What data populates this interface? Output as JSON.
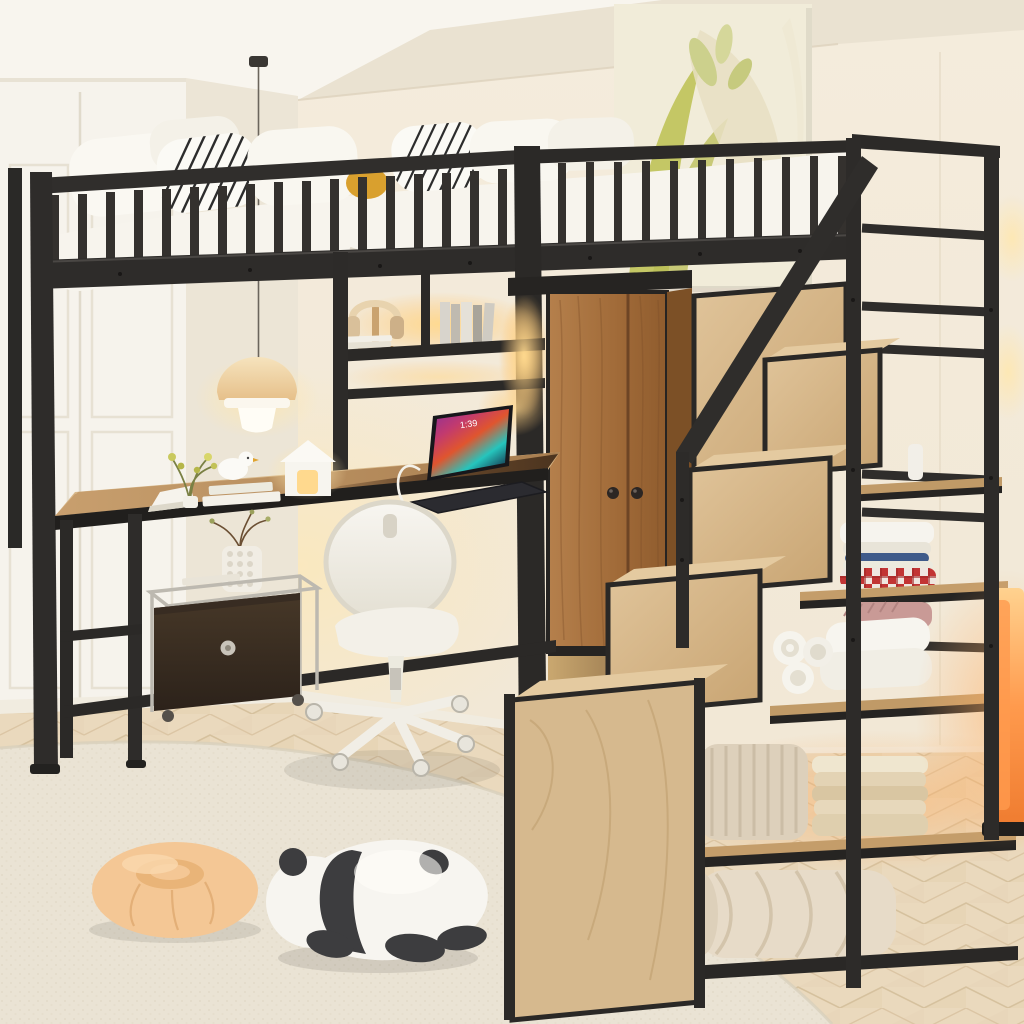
{
  "title": "Black metal loft bed with desk, wardrobe and storage staircase in a cream bedroom",
  "laptop": {
    "clock": "1:39"
  },
  "colors": {
    "ceiling": "#eae2d1",
    "soffit": "#f8f5ee",
    "wall": "#f3eadb",
    "closet": "#f6f3ec",
    "closetSide": "#ece5d6",
    "canvas": "#f1ecd9",
    "artGreen": "#c4c765",
    "metal": "#2e2c2a",
    "metalDark": "#211f1d",
    "wardrobeWood": "#a97441",
    "wardrobeSide": "#7c5026",
    "stepWood": "#d6b98e",
    "shelfWood": "#c09a67",
    "deskWood": "#bd9464",
    "deskDark": "#5e4026",
    "mattress": "#f7f4ed",
    "stripe": "#2c2c2c",
    "accentYellow": "#d9a02e",
    "ledWarm": "#ffc878",
    "rug": "#eae3d4",
    "floor": "#ead9bd",
    "chair": "#f3f0e8",
    "chrome": "#bdb9b0",
    "drawer": "#382c22",
    "vase": "#f1ede4",
    "plush": "#f7f5f0",
    "pandaBlack": "#3d3d3f",
    "donut": "#f4c795",
    "lampOrange": "#ff9a4d",
    "towelBlue": "#3f5b8a",
    "plaidRed": "#c23434"
  }
}
